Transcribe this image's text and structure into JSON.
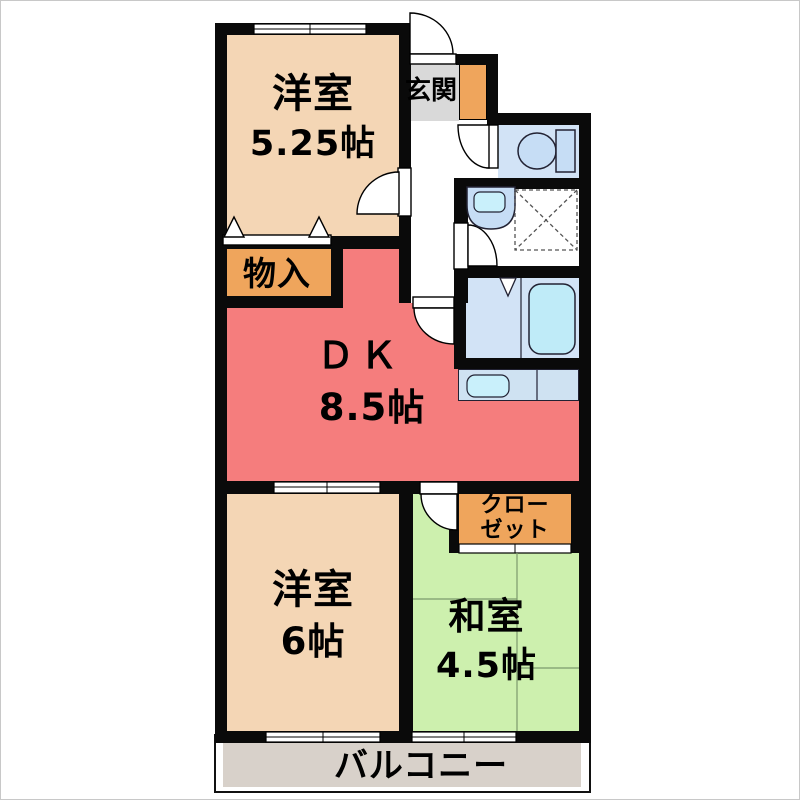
{
  "plan": {
    "type": "apartment-floorplan",
    "rooms": {
      "western_room_top": {
        "label": "洋室",
        "area": "5.25帖"
      },
      "entrance": {
        "label": "玄関"
      },
      "storage": {
        "label": "物入"
      },
      "dining_kitchen": {
        "label": "ＤＫ",
        "area": "8.5帖"
      },
      "closet": {
        "label_line1": "クロー",
        "label_line2": "ゼット"
      },
      "western_room_bottom": {
        "label": "洋室",
        "area": "6帖"
      },
      "japanese_room": {
        "label": "和室",
        "area": "4.5帖"
      },
      "balcony": {
        "label": "バルコニー"
      }
    },
    "icons": {
      "toilet": "toilet-icon",
      "washbasin": "washbasin-icon",
      "bathtub": "bathtub-icon",
      "bath_folding_door": "folding-door-icon",
      "washing_machine_space": "washing-machine-space-icon",
      "kitchen_sink": "kitchen-sink-icon",
      "door_swing": "door-swing-icon",
      "window": "window-icon",
      "storage_door_triangles": "hinged-door-triangle-icon"
    },
    "colors": {
      "wall": "#0a0a0a",
      "western_room": "#f4d6b5",
      "dining_kitchen": "#f57d7d",
      "storage": "#efa55c",
      "japanese_room": "#cdf0ae",
      "entrance_floor": "#d9d9d9",
      "water_area": "#d2e3f6",
      "bathtub": "#bfebf8",
      "fixture_fill": "#c6ddf5",
      "fixture_inner": "#c9f0fb",
      "counter": "#cfe2f2",
      "balcony_floor": "#d8d1ca",
      "tatami_line": "#7d9a6d"
    }
  }
}
